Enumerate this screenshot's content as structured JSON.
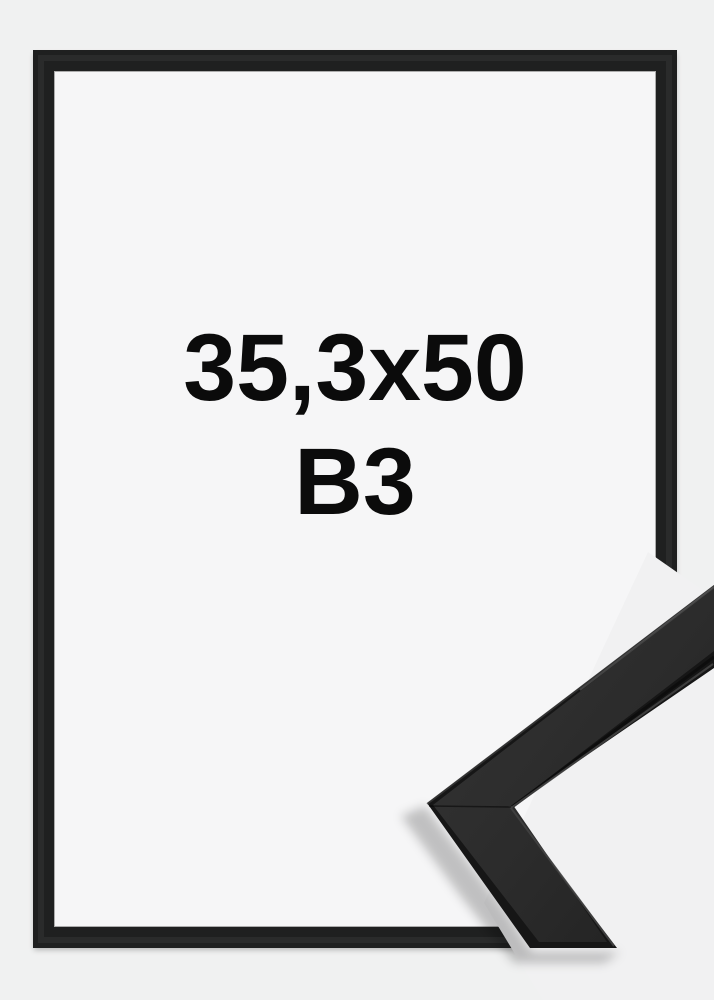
{
  "product_image": {
    "size_label": "35,3x50",
    "format_label": "B3",
    "icons": {
      "corner_sample": "frame-corner-sample-icon"
    },
    "colors": {
      "page_background": "#f0f1f1",
      "frame_interior": "#f6f6f7",
      "frame_border": "#1f2020",
      "label_text": "#0b0b0b",
      "moulding_face": "#2d2d2d",
      "moulding_edge": "#161616"
    }
  }
}
